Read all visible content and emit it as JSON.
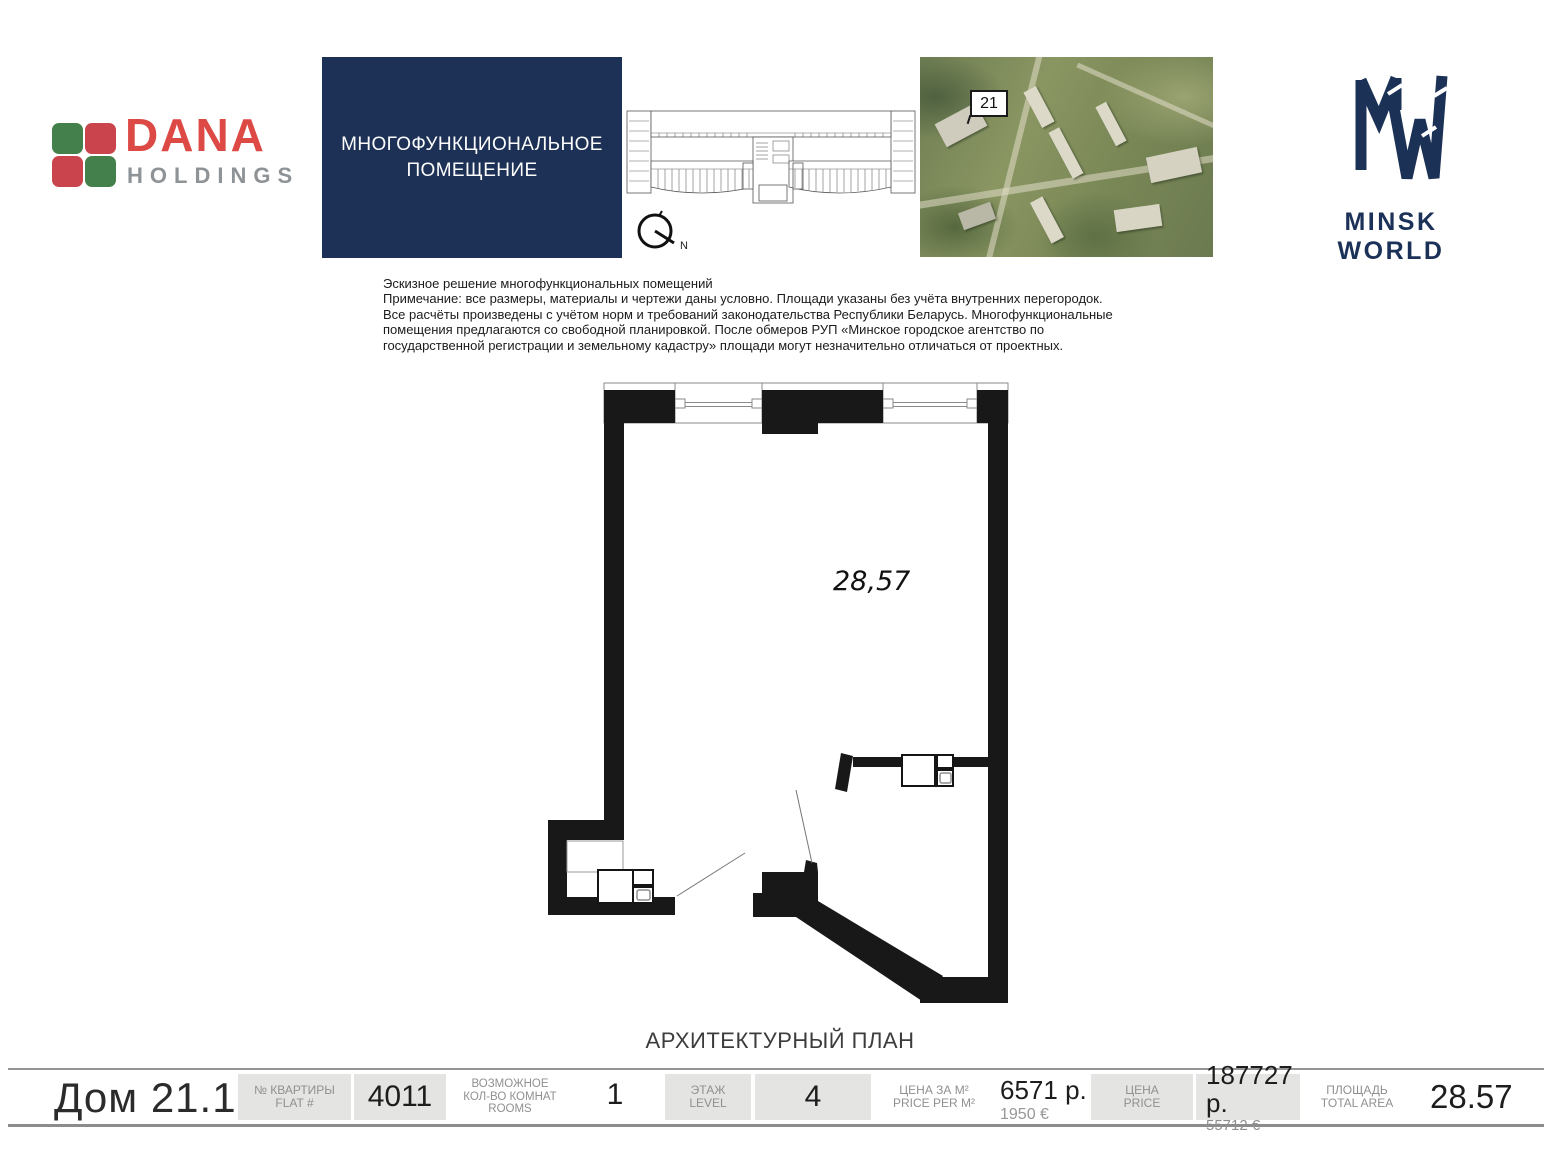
{
  "header": {
    "dana": {
      "name": "DANA",
      "sub": "HOLDINGS"
    },
    "navy_box_title": "МНОГОФУНКЦИОНАЛЬНОЕ\nПОМЕЩЕНИЕ",
    "compass_label": "N",
    "aerial_tag": "21",
    "minsk_world": "MINSK WORLD"
  },
  "disclaimer": "Эскизное решение многофункциональных помещений\nПримечание: все размеры, материалы и чертежи даны условно. Площади указаны без учёта внутренних перегородок.\nВсе расчёты произведены с учётом норм и требований законодательства Республики Беларусь. Многофункциональные\nпомещения предлагаются со свободной планировкой. После обмеров РУП «Минское городское агентство по\nгосударственной регистрации и земельному кадастру» площади могут незначительно отличаться от проектных.",
  "plan": {
    "area_label": "28,57",
    "caption": "АРХИТЕКТУРНЫЙ ПЛАН"
  },
  "bottom_bar": {
    "house": "Дом 21.1",
    "flat_label_ru": "№ КВАРТИРЫ",
    "flat_label_en": "FLAT #",
    "flat_value": "4011",
    "rooms_label_l1": "ВОЗМОЖНОЕ",
    "rooms_label_l2": "КОЛ-ВО КОМНАТ",
    "rooms_label_l3": "ROOMS",
    "rooms_value": "1",
    "level_label_ru": "ЭТАЖ",
    "level_label_en": "LEVEL",
    "level_value": "4",
    "price_per_m2_label_ru": "ЦЕНА ЗА М²",
    "price_per_m2_label_en": "PRICE PER M²",
    "price_per_m2_value": "6571 р.",
    "price_per_m2_value_eur": "1950 €",
    "price_label_ru": "ЦЕНА",
    "price_label_en": "PRICE",
    "price_value": "187727 р.",
    "price_value_eur": "55712 €",
    "area_label_ru": "ПЛОЩАДЬ",
    "area_label_en": "TOTAL AREA",
    "area_value": "28.57"
  },
  "colors": {
    "brand_navy": "#1d3156",
    "dana_red": "#dd4a45",
    "dana_green": "#43804c",
    "gray_box": "#e4e4e3",
    "wall_black": "#181818"
  }
}
